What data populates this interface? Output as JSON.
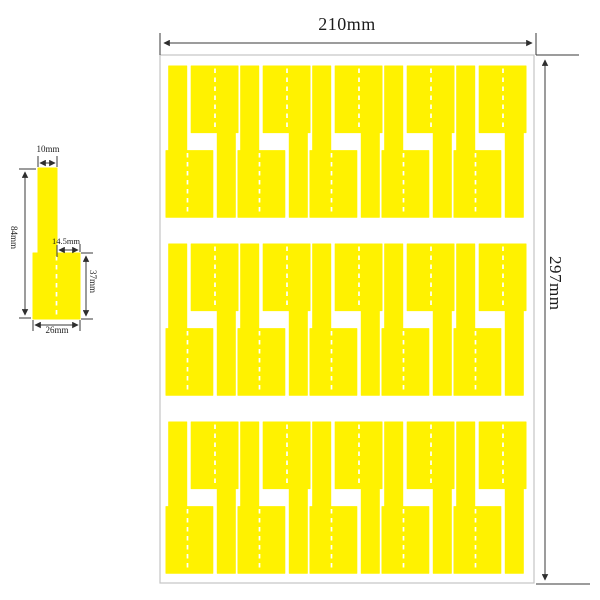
{
  "sheet": {
    "width_label": "210mm",
    "height_label": "297mm",
    "rows": 3,
    "pairs_per_row": 5,
    "labels_per_row": 10,
    "colors": {
      "label_yellow": "#FFF200",
      "fold_white": "#FFFFFF",
      "dim_gray": "#3A3A3A",
      "sheet_border": "#C4C4C4"
    }
  },
  "detail": {
    "strip_width_label": "10mm",
    "total_height_label": "84mm",
    "tail_width_label": "14.5mm",
    "flag_height_label": "37mm",
    "base_width_label": "26mm"
  }
}
